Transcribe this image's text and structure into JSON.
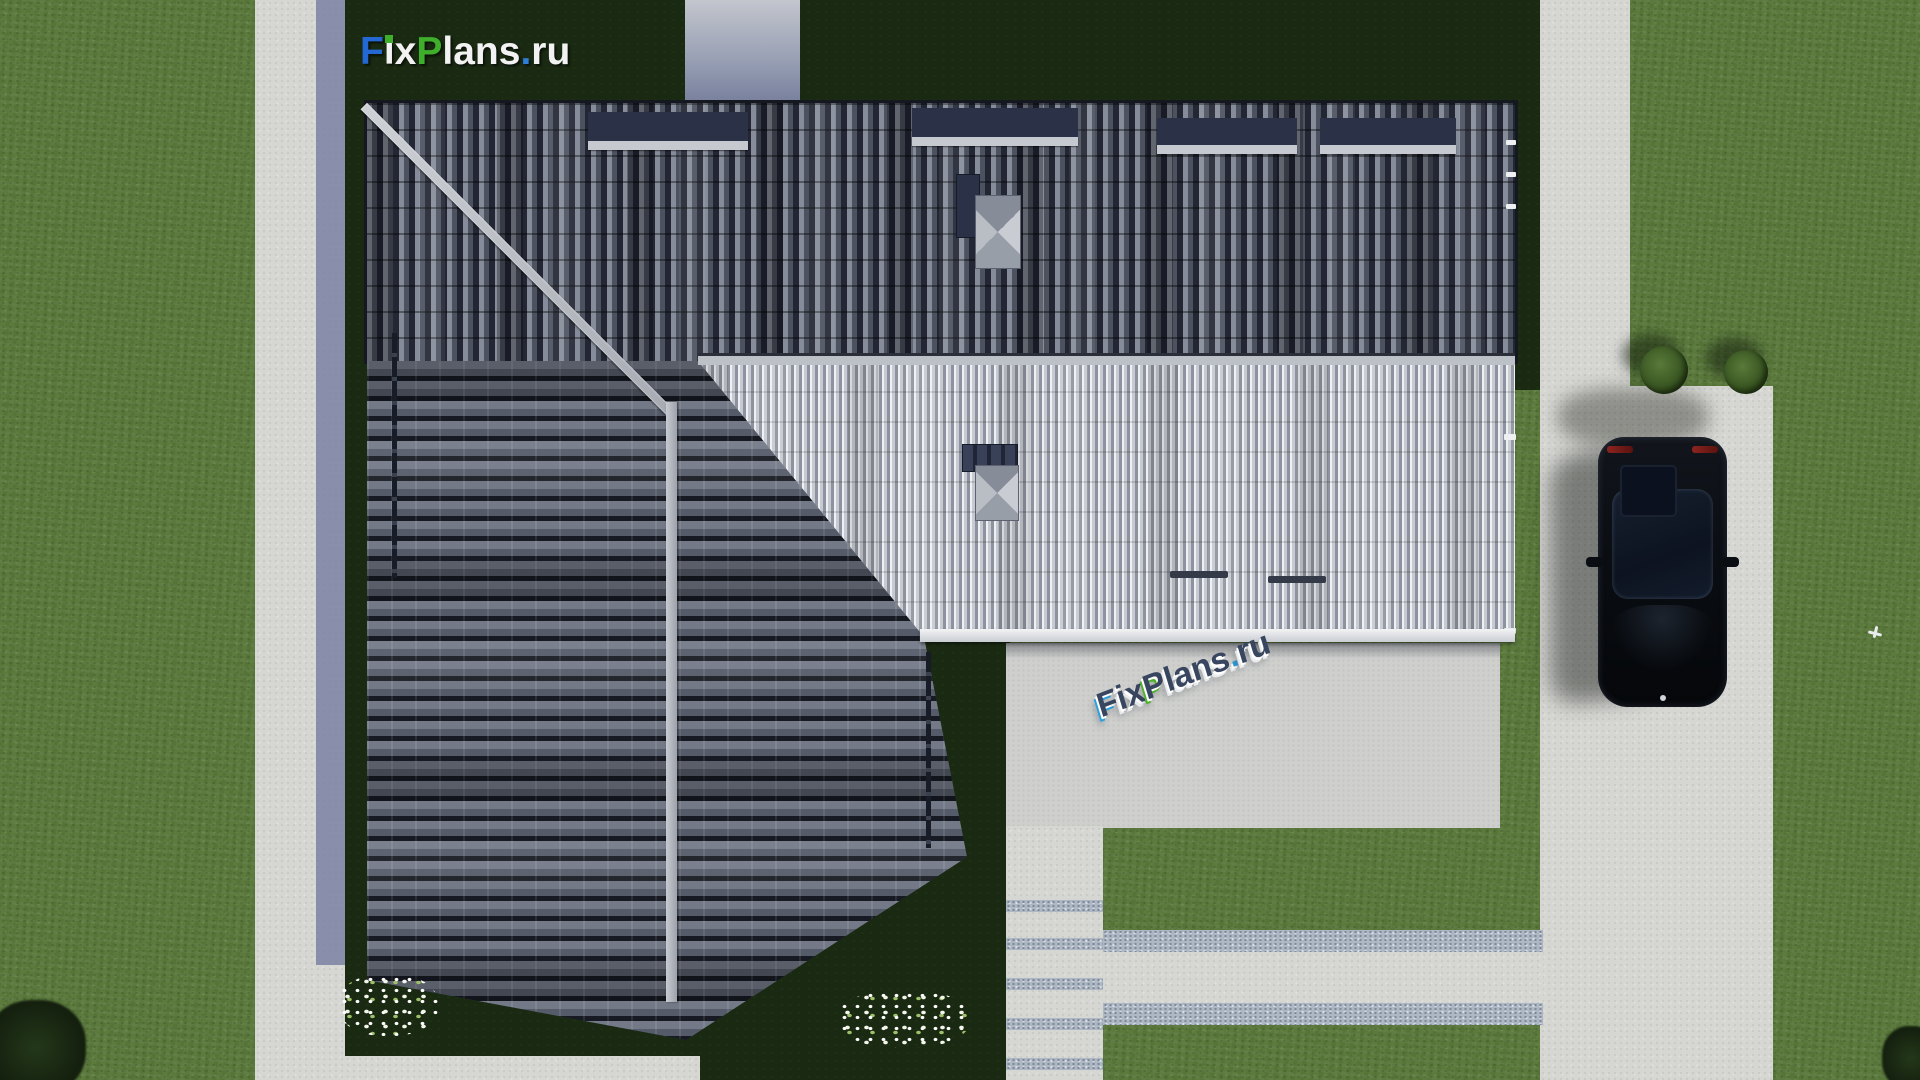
{
  "logo": {
    "text": "FixPlans.ru",
    "parts": {
      "f": "F",
      "i": "i",
      "x": "x",
      "p": "P",
      "lans": "lans",
      "dot": ".",
      "ru": "ru"
    },
    "colors": {
      "f_blue": "#2468d4",
      "p_green": "#3fae2a",
      "i_dot_green": "#3fae2a",
      "letters_white": "#f2f2f2",
      "dot_blue": "#2f7fd6"
    }
  },
  "watermark": {
    "text": "FixPlans.ru",
    "style": "3d-extruded-on-patio",
    "parts": {
      "f": "F",
      "ix": "ix",
      "p": "P",
      "lans": "lans",
      "dot": ".",
      "ru": "ru"
    },
    "colors": {
      "top": "#39465f",
      "side": "#ffffff",
      "f_face": "#2aa0df",
      "p_face": "#4db32c"
    }
  },
  "scene": {
    "view": "top-down aerial 3D render of a house plot",
    "lawn_color": "#5b7a3c",
    "shadowed_lawn_color": "#1a2a12",
    "roof": {
      "dark_tile_color": "#3b4150",
      "light_metal_color": "#b4b8bf",
      "ridge_color": "#b7bac0",
      "gutter_color": "#eef0f2",
      "chimney_count": 2
    },
    "hardscape": {
      "path_color": "#d6d6d3",
      "gravel_joint_color": "#aeb7c4",
      "patio_color": "#cfd0ce",
      "shaded_path_color": "#7b83a3"
    },
    "car": {
      "type": "sedan-top-view",
      "body_color": "#0a0d12",
      "taillight_color": "#8c2420"
    },
    "tree_count": 2,
    "flower_bed_count": 2
  }
}
